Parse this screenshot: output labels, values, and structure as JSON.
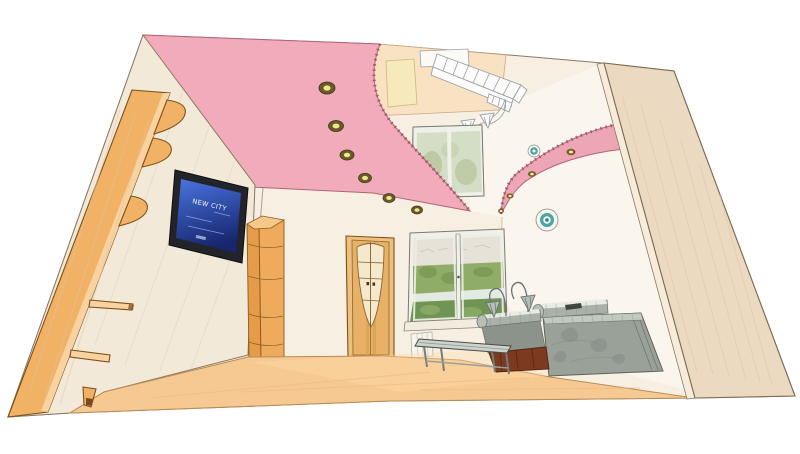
{
  "image_type": "3d-interior-render",
  "description": "Perspective 3D visualization of a living room: two-level pink and cream stretch ceiling with recessed spotlights, curved pink ceiling wing, wall-mounted TV, orange wardrobe panel with curved corner shelves, wooden door with oval glass inset, corner shelf column, two windows with green landscape view, ceiling vent sketch, wall lamps, gray marble sofa with floor lamps and a low coffee table on a light wood floor.",
  "tv": {
    "screen_text": "NEW CITY"
  },
  "scene": {
    "ceiling_spotlights": 6,
    "wing_spotlights": 4,
    "wall_plates": 2,
    "windows": 2,
    "objects": [
      "pink ceiling",
      "ceiling wing",
      "spotlights",
      "vent grille sketch",
      "wall lamp",
      "upper window",
      "lower window",
      "door",
      "corner shelf column",
      "wall TV",
      "wardrobe panel with shelves",
      "sofa",
      "floor lamps",
      "coffee table",
      "decorative plates",
      "wood floor",
      "right wall",
      "left wall"
    ]
  },
  "colors": {
    "background": "#ffffff",
    "interior_cream": "#f7efe2",
    "left_wall": "#f2e9d8",
    "ceiling_pink": "#f2abba",
    "wing_pink": "#eda6b4",
    "soffit_peach": "#f8e2c2",
    "high_window_yellow": "#f6e9bb",
    "vent_white": "#fbfaf6",
    "tan_wall": "#ecd9c1",
    "tan_wall_edge": "#f7ecd9",
    "panel_orange": "#f1b266",
    "panel_edge": "#f8d2a0",
    "floor": "#f7c992",
    "door_leaf": "#e8b167",
    "door_frame": "#edc07e",
    "door_inset": "#f4e9cd",
    "shelf_column": "#efab5c",
    "shelf_column_side": "#e69b48",
    "shelf_column_top": "#f6c98b",
    "tv_frame": "#23232a",
    "tv_text": "#ffffff",
    "window_frame": "#eff1e9",
    "upper_glass": "#d4ddc6",
    "view_sky": "#e7e2d8",
    "view_green": "#90ad68",
    "view_green_dark": "#6f9454",
    "view_river": "#e3eae2",
    "sill": "#f2ece0",
    "radiator": "#f7f4ec",
    "plate_rim": "#f6f6f0",
    "plate_teal": "#4aa6a0",
    "spot_ring": "#6b5a26",
    "spot_core": "#ece98f",
    "wing_light_ring": "#7d5c1b",
    "wing_light_core": "#f3ecd2",
    "sofa_slab": "#99a199",
    "sofa_bolster": "#aab1a9",
    "sofa_seat": "#8b938b",
    "sofa_band": "#e9ebe5",
    "sofa_base": "#7c3a20",
    "table": "#ccd2cc",
    "lamp_shade": "#b7beb6"
  }
}
